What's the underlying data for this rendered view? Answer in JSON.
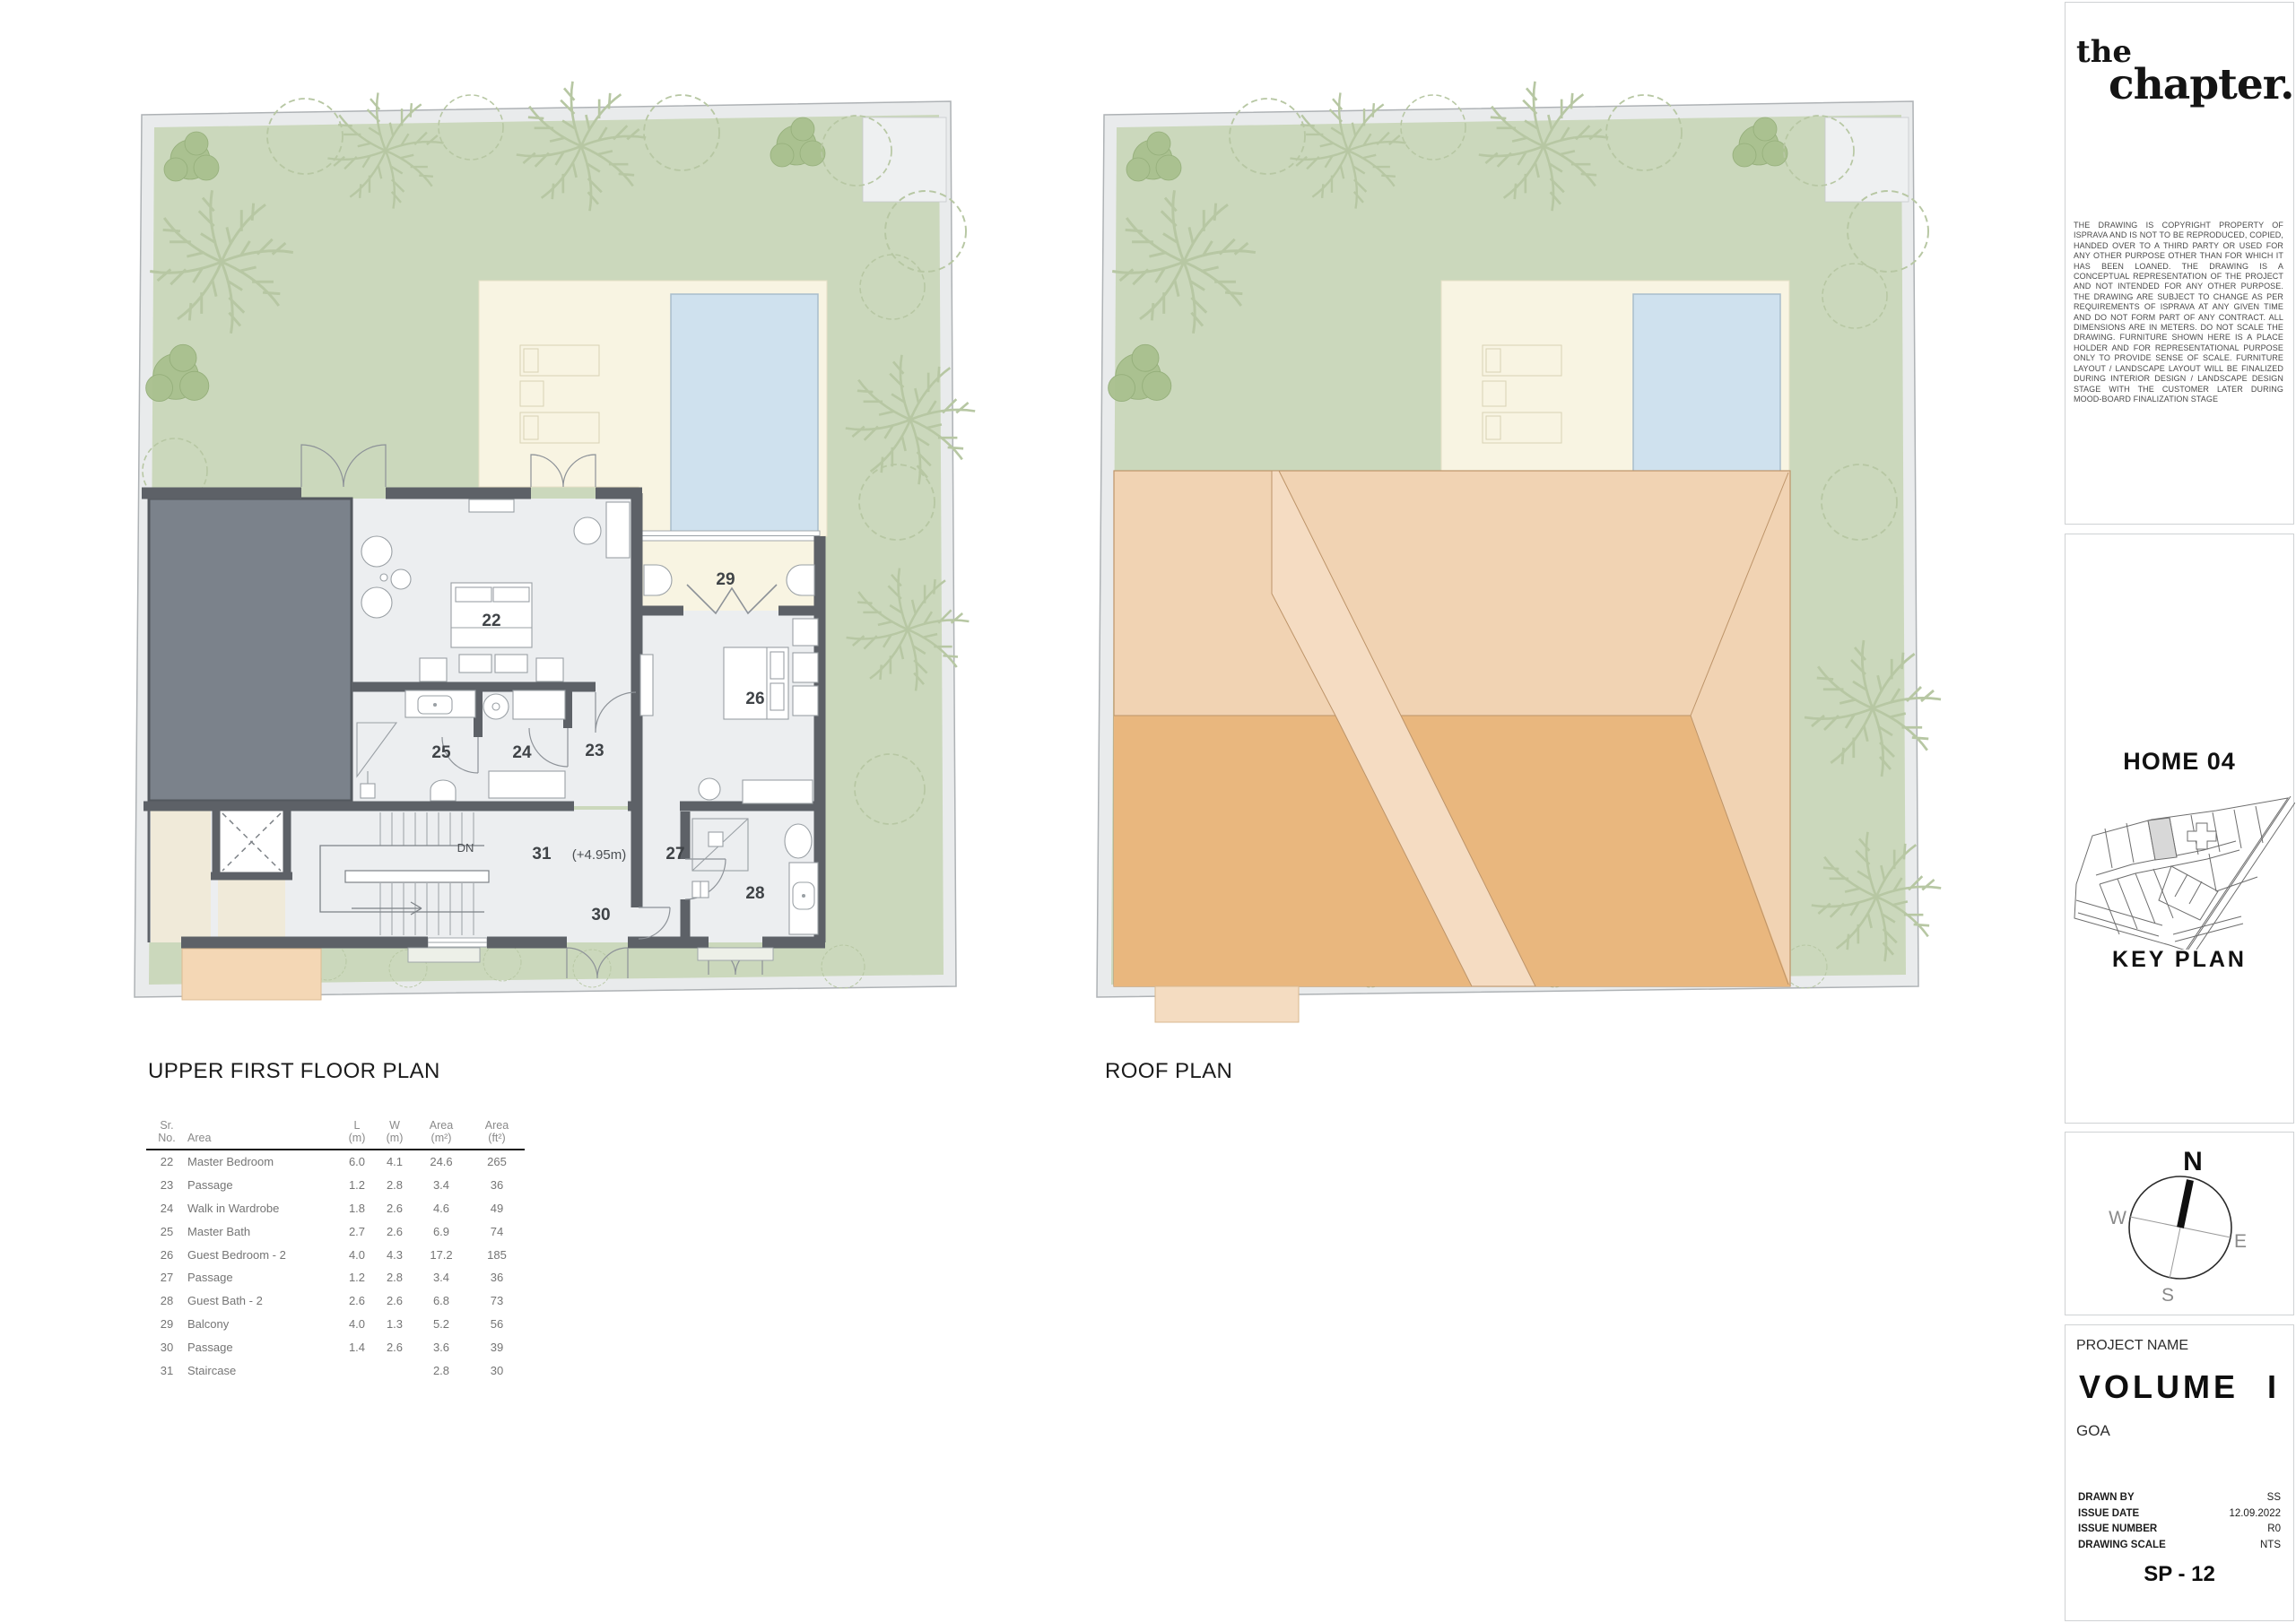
{
  "plans": {
    "upper": {
      "title": "UPPER FIRST FLOOR PLAN",
      "dn": "DN",
      "level": "(+4.95m)"
    },
    "roof": {
      "title": "ROOF PLAN"
    }
  },
  "area_table": {
    "headers": {
      "sr_top": "Sr.",
      "sr_bot": "No.",
      "area": "Area",
      "l_top": "L",
      "l_bot": "(m)",
      "w_top": "W",
      "w_bot": "(m)",
      "m2_top": "Area",
      "m2_bot": "(m²)",
      "ft2_top": "Area",
      "ft2_bot": "(ft²)"
    },
    "rows": [
      {
        "sr": "22",
        "name": "Master Bedroom",
        "l": "6.0",
        "w": "4.1",
        "m2": "24.6",
        "ft2": "265"
      },
      {
        "sr": "23",
        "name": "Passage",
        "l": "1.2",
        "w": "2.8",
        "m2": "3.4",
        "ft2": "36"
      },
      {
        "sr": "24",
        "name": "Walk in Wardrobe",
        "l": "1.8",
        "w": "2.6",
        "m2": "4.6",
        "ft2": "49"
      },
      {
        "sr": "25",
        "name": "Master Bath",
        "l": "2.7",
        "w": "2.6",
        "m2": "6.9",
        "ft2": "74"
      },
      {
        "sr": "26",
        "name": "Guest Bedroom - 2",
        "l": "4.0",
        "w": "4.3",
        "m2": "17.2",
        "ft2": "185"
      },
      {
        "sr": "27",
        "name": "Passage",
        "l": "1.2",
        "w": "2.8",
        "m2": "3.4",
        "ft2": "36"
      },
      {
        "sr": "28",
        "name": "Guest Bath - 2",
        "l": "2.6",
        "w": "2.6",
        "m2": "6.8",
        "ft2": "73"
      },
      {
        "sr": "29",
        "name": "Balcony",
        "l": "4.0",
        "w": "1.3",
        "m2": "5.2",
        "ft2": "56"
      },
      {
        "sr": "30",
        "name": "Passage",
        "l": "1.4",
        "w": "2.6",
        "m2": "3.6",
        "ft2": "39"
      },
      {
        "sr": "31",
        "name": "Staircase",
        "l": "",
        "w": "",
        "m2": "2.8",
        "ft2": "30"
      }
    ]
  },
  "title_block": {
    "logo_line1": "the",
    "logo_line2": "chapter.",
    "copyright": "THE DRAWING IS COPYRIGHT PROPERTY OF ISPRAVA AND IS NOT TO BE REPRODUCED, COPIED, HANDED OVER TO A THIRD PARTY OR USED FOR ANY OTHER PURPOSE OTHER THAN FOR WHICH IT HAS BEEN LOANED. THE DRAWING IS A CONCEPTUAL REPRESENTATION OF THE PROJECT AND NOT INTENDED FOR ANY OTHER PURPOSE. THE DRAWING ARE SUBJECT TO CHANGE AS PER REQUIREMENTS OF ISPRAVA AT ANY GIVEN TIME AND DO NOT FORM PART OF ANY CONTRACT. ALL DIMENSIONS ARE IN METERS. DO NOT SCALE THE DRAWING. FURNITURE SHOWN HERE IS A PLACE HOLDER AND FOR REPRESENTATIONAL PURPOSE ONLY TO PROVIDE SENSE OF SCALE. FURNITURE LAYOUT / LANDSCAPE LAYOUT WILL BE FINALIZED DURING INTERIOR DESIGN / LANDSCAPE DESIGN STAGE WITH THE CUSTOMER LATER DURING MOOD-BOARD FINALIZATION STAGE",
    "home": "HOME 04",
    "key_plan": "KEY PLAN",
    "compass": {
      "n": "N",
      "e": "E",
      "s": "S",
      "w": "W"
    },
    "project_label": "PROJECT NAME",
    "project_name": "VOLUME I",
    "location": "GOA",
    "fields": [
      {
        "label": "DRAWN BY",
        "value": "SS"
      },
      {
        "label": "ISSUE DATE",
        "value": "12.09.2022"
      },
      {
        "label": "ISSUE NUMBER",
        "value": "R0"
      },
      {
        "label": "DRAWING SCALE",
        "value": "NTS"
      }
    ],
    "sheet_no": "SP - 12"
  },
  "colors": {
    "garden": "#cbd8bc",
    "site_band": "#e9ebec",
    "deck": "#f8f4e2",
    "pool": "#cfe1ee",
    "wall": "#5d6167",
    "room": "#eceef0",
    "dark_block": "#7b828b",
    "roof_light": "#f1d3b3",
    "roof_dark": "#e9b77e",
    "roof_valley": "#f5dcc2",
    "accent_tan": "#f4d7b5"
  }
}
